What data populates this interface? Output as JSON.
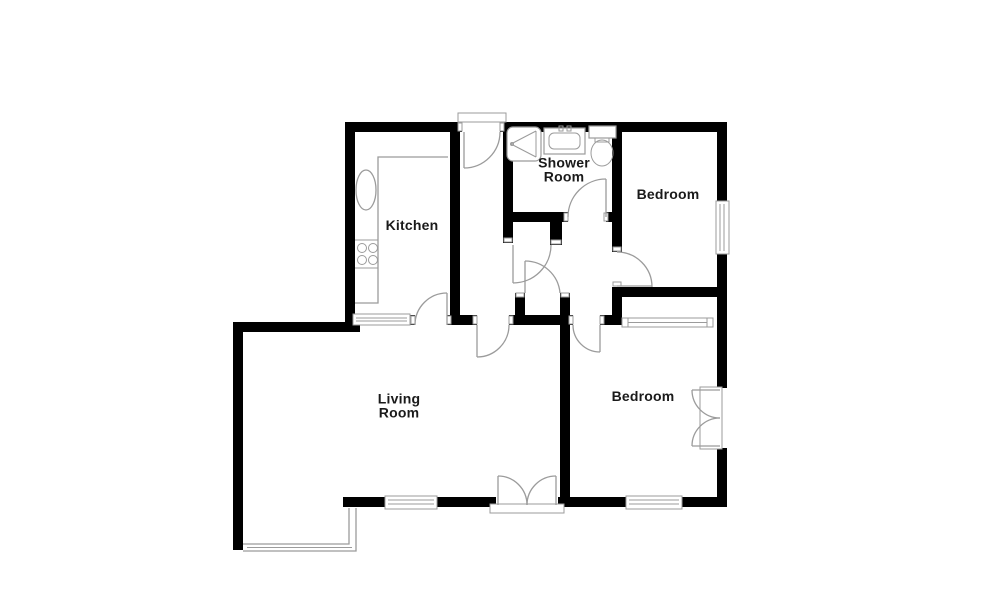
{
  "title": "Floor plan",
  "colors": {
    "wall": "#000000",
    "line": "#9b9b9b",
    "text": "#1a1a1a",
    "bg": "#ffffff"
  },
  "rooms": [
    {
      "id": "kitchen",
      "label": "Kitchen"
    },
    {
      "id": "shower-room",
      "label": "Shower\nRoom"
    },
    {
      "id": "bedroom-top",
      "label": "Bedroom"
    },
    {
      "id": "living-room",
      "label": "Living\nRoom"
    },
    {
      "id": "bedroom-bottom",
      "label": "Bedroom"
    }
  ],
  "fixtures": [
    "shower-tray",
    "wash-basin",
    "toilet",
    "kitchen-counter",
    "kitchen-sink",
    "hob",
    "bay-window",
    "wardrobe",
    "entrance-door",
    "french-doors",
    "windows",
    "internal-doors"
  ]
}
